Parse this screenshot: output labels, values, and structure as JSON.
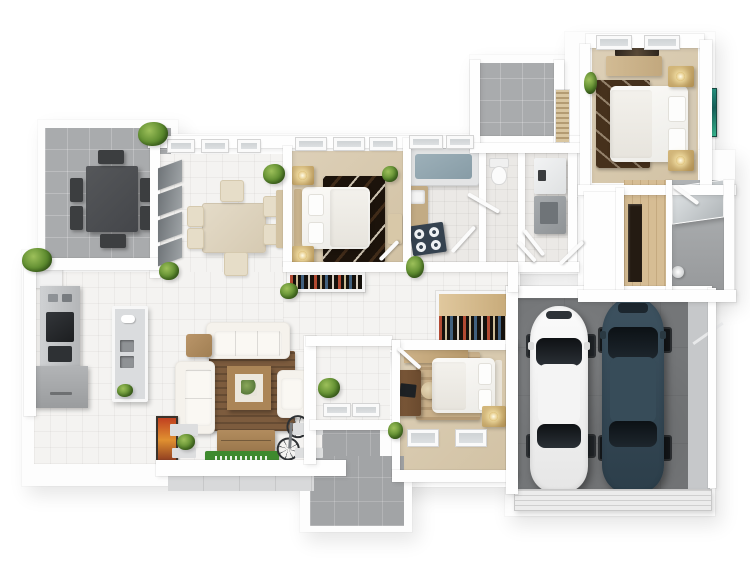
{
  "image": {
    "type": "3D floor plan rendering",
    "description": "Photorealistic top-down 3D architectural floor plan of a 3-bedroom house with attached two-car garage, outdoor patios, open-plan kitchen/dining/living area",
    "background": "#ffffff"
  },
  "palette": {
    "wall_white": "#fdfdfd",
    "tile_floor": "#f4f3f1",
    "bathroom_tile": "#ebe9e6",
    "bedroom_floor_beige": "#d8c9ad",
    "wood_floor": "#d6bd94",
    "outdoor_patio_gray": "#a9abad",
    "garage_concrete": "#747678",
    "living_rug_brown": "#7d5c3e",
    "dark_rug_brown": "#1c130b",
    "accent_gold": "#c3a368",
    "car_white": "#f2f2f2",
    "car_dark_teal": "#384f5e",
    "plant_green": "#5c8a2e",
    "welcome_mat_green": "#3e8a2e",
    "bathtub_water": "#93a7b0",
    "teal_artwork": "#2aa08a",
    "orange_artwork": "#d8502a"
  },
  "rooms": [
    {
      "id": "patio-terrace",
      "label": "Outdoor patio with dining set"
    },
    {
      "id": "dining-room",
      "label": "Dining room"
    },
    {
      "id": "bedroom-2",
      "label": "Bedroom 2"
    },
    {
      "id": "bathroom",
      "label": "Bathroom with bathtub"
    },
    {
      "id": "wc",
      "label": "WC / toilet room"
    },
    {
      "id": "pantry",
      "label": "Pantry / utility room with refrigerator"
    },
    {
      "id": "upper-terrace",
      "label": "Upper terrace"
    },
    {
      "id": "master-bedroom",
      "label": "Master bedroom"
    },
    {
      "id": "hall-closet",
      "label": "Hallway closet with wood floor"
    },
    {
      "id": "shower-bathroom",
      "label": "Shower bathroom"
    },
    {
      "id": "garage",
      "label": "Two-car garage"
    },
    {
      "id": "kitchen",
      "label": "Kitchen"
    },
    {
      "id": "living-room",
      "label": "Living room"
    },
    {
      "id": "entry-porch",
      "label": "Entry porch"
    },
    {
      "id": "bedroom-3",
      "label": "Bedroom 3 with desk"
    },
    {
      "id": "rear-patio",
      "label": "Rear patio"
    },
    {
      "id": "hallway",
      "label": "Central hallway"
    }
  ],
  "furniture": {
    "patio_terrace": [
      "dark outdoor dining table",
      "6 dark chairs",
      "2 potted plants"
    ],
    "dining_room": [
      "cream dining table",
      "6 cream chairs",
      "sideboard",
      "floor-to-ceiling windows",
      "plants"
    ],
    "bedroom_2": [
      "double bed with white bedding",
      "2 gold nightstands with lamps",
      "dark patterned rug",
      "bench",
      "plant",
      "wardrobe shelf with clothes"
    ],
    "bathroom": [
      "bathtub filled with water",
      "wood vanity with sink",
      "four-burner appliance"
    ],
    "wc": [
      "toilet"
    ],
    "pantry": [
      "refrigerator",
      "white cabinet"
    ],
    "master_bedroom": [
      "double bed with white bedding",
      "2 gold nightstands with lamps",
      "dark brown rug",
      "dresser",
      "dark wall art",
      "teal painting",
      "plant"
    ],
    "hall_closet": [
      "dark floor opening",
      "2 wood wall shelves"
    ],
    "shower_bathroom": [
      "glass shower screen",
      "floor fixture"
    ],
    "garage": [
      "white car",
      "dark teal car",
      "sectional garage door",
      "storage shelf"
    ],
    "kitchen": [
      "appliance tower with oven and microwave",
      "gray counter",
      "island with double sink",
      "white cabinet"
    ],
    "living_room": [
      "three-seat sofa",
      "two-seat sofa",
      "armchair",
      "brown rug",
      "square coffee table",
      "side table",
      "TV console",
      "green welcome mat",
      "orange wall art",
      "bicycle",
      "plants"
    ],
    "entry_porch": [
      "plant",
      "glazed floor panels"
    ],
    "bedroom_3": [
      "double bed",
      "desk with monitor",
      "chair",
      "gold nightstand with lamp",
      "tan rug",
      "wardrobe strip",
      "plant",
      "2 floor windows"
    ]
  },
  "cars": [
    {
      "position": "left",
      "color_name": "white",
      "hex": "#f2f2f2"
    },
    {
      "position": "right",
      "color_name": "dark teal",
      "hex": "#384f5e"
    }
  ]
}
